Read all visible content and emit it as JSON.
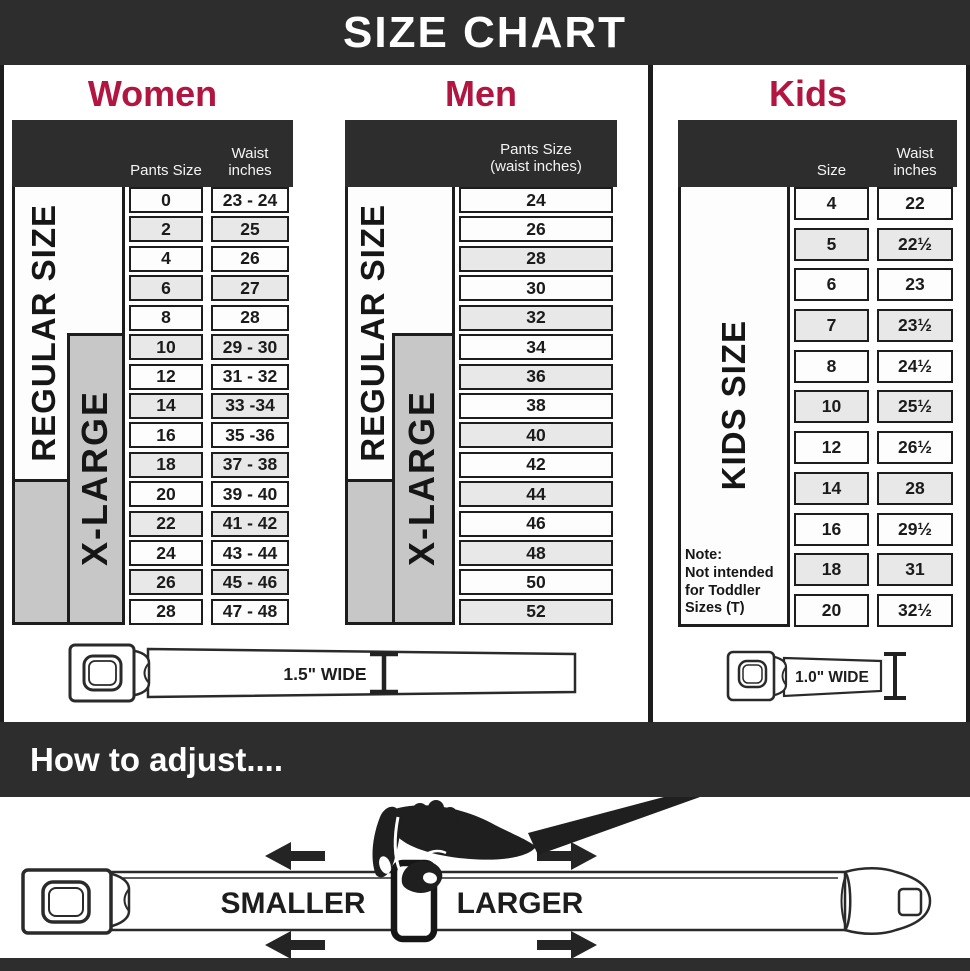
{
  "title": "SIZE CHART",
  "colors": {
    "banner_dark": "#2d2d2d",
    "accent_red": "#b11540",
    "gray_fill": "#c7c7c7",
    "line_dark": "#1d1d1d"
  },
  "tables": {
    "women": {
      "heading": "Women",
      "col1_header": "Pants Size",
      "col2_header": "Waist\ninches",
      "regular_label": "REGULAR SIZE",
      "xlarge_label": "X-LARGE",
      "rows": [
        [
          "0",
          "23 - 24"
        ],
        [
          "2",
          "25"
        ],
        [
          "4",
          "26"
        ],
        [
          "6",
          "27"
        ],
        [
          "8",
          "28"
        ],
        [
          "10",
          "29 - 30"
        ],
        [
          "12",
          "31 - 32"
        ],
        [
          "14",
          "33 -34"
        ],
        [
          "16",
          "35 -36"
        ],
        [
          "18",
          "37 - 38"
        ],
        [
          "20",
          "39 - 40"
        ],
        [
          "22",
          "41 - 42"
        ],
        [
          "24",
          "43 - 44"
        ],
        [
          "26",
          "45 - 46"
        ],
        [
          "28",
          "47 - 48"
        ]
      ]
    },
    "men": {
      "heading": "Men",
      "col_header": "Pants Size\n(waist inches)",
      "regular_label": "REGULAR SIZE",
      "xlarge_label": "X-LARGE",
      "rows": [
        "24",
        "26",
        "28",
        "30",
        "32",
        "34",
        "36",
        "38",
        "40",
        "42",
        "44",
        "46",
        "48",
        "50",
        "52"
      ]
    },
    "kids": {
      "heading": "Kids",
      "col1_header": "Size",
      "col2_header": "Waist\ninches",
      "side_label": "KIDS SIZE",
      "note_title": "Note:",
      "note_body": "Not intended for Toddler Sizes (T)",
      "rows": [
        [
          "4",
          "22"
        ],
        [
          "5",
          "22½"
        ],
        [
          "6",
          "23"
        ],
        [
          "7",
          "23½"
        ],
        [
          "8",
          "24½"
        ],
        [
          "10",
          "25½"
        ],
        [
          "12",
          "26½"
        ],
        [
          "14",
          "28"
        ],
        [
          "16",
          "29½"
        ],
        [
          "18",
          "31"
        ],
        [
          "20",
          "32½"
        ]
      ]
    }
  },
  "belts": {
    "adult_width_label": "1.5\" WIDE",
    "kids_width_label": "1.0\" WIDE"
  },
  "adjust": {
    "heading": "How to adjust....",
    "smaller_label": "SMALLER",
    "larger_label": "LARGER"
  }
}
